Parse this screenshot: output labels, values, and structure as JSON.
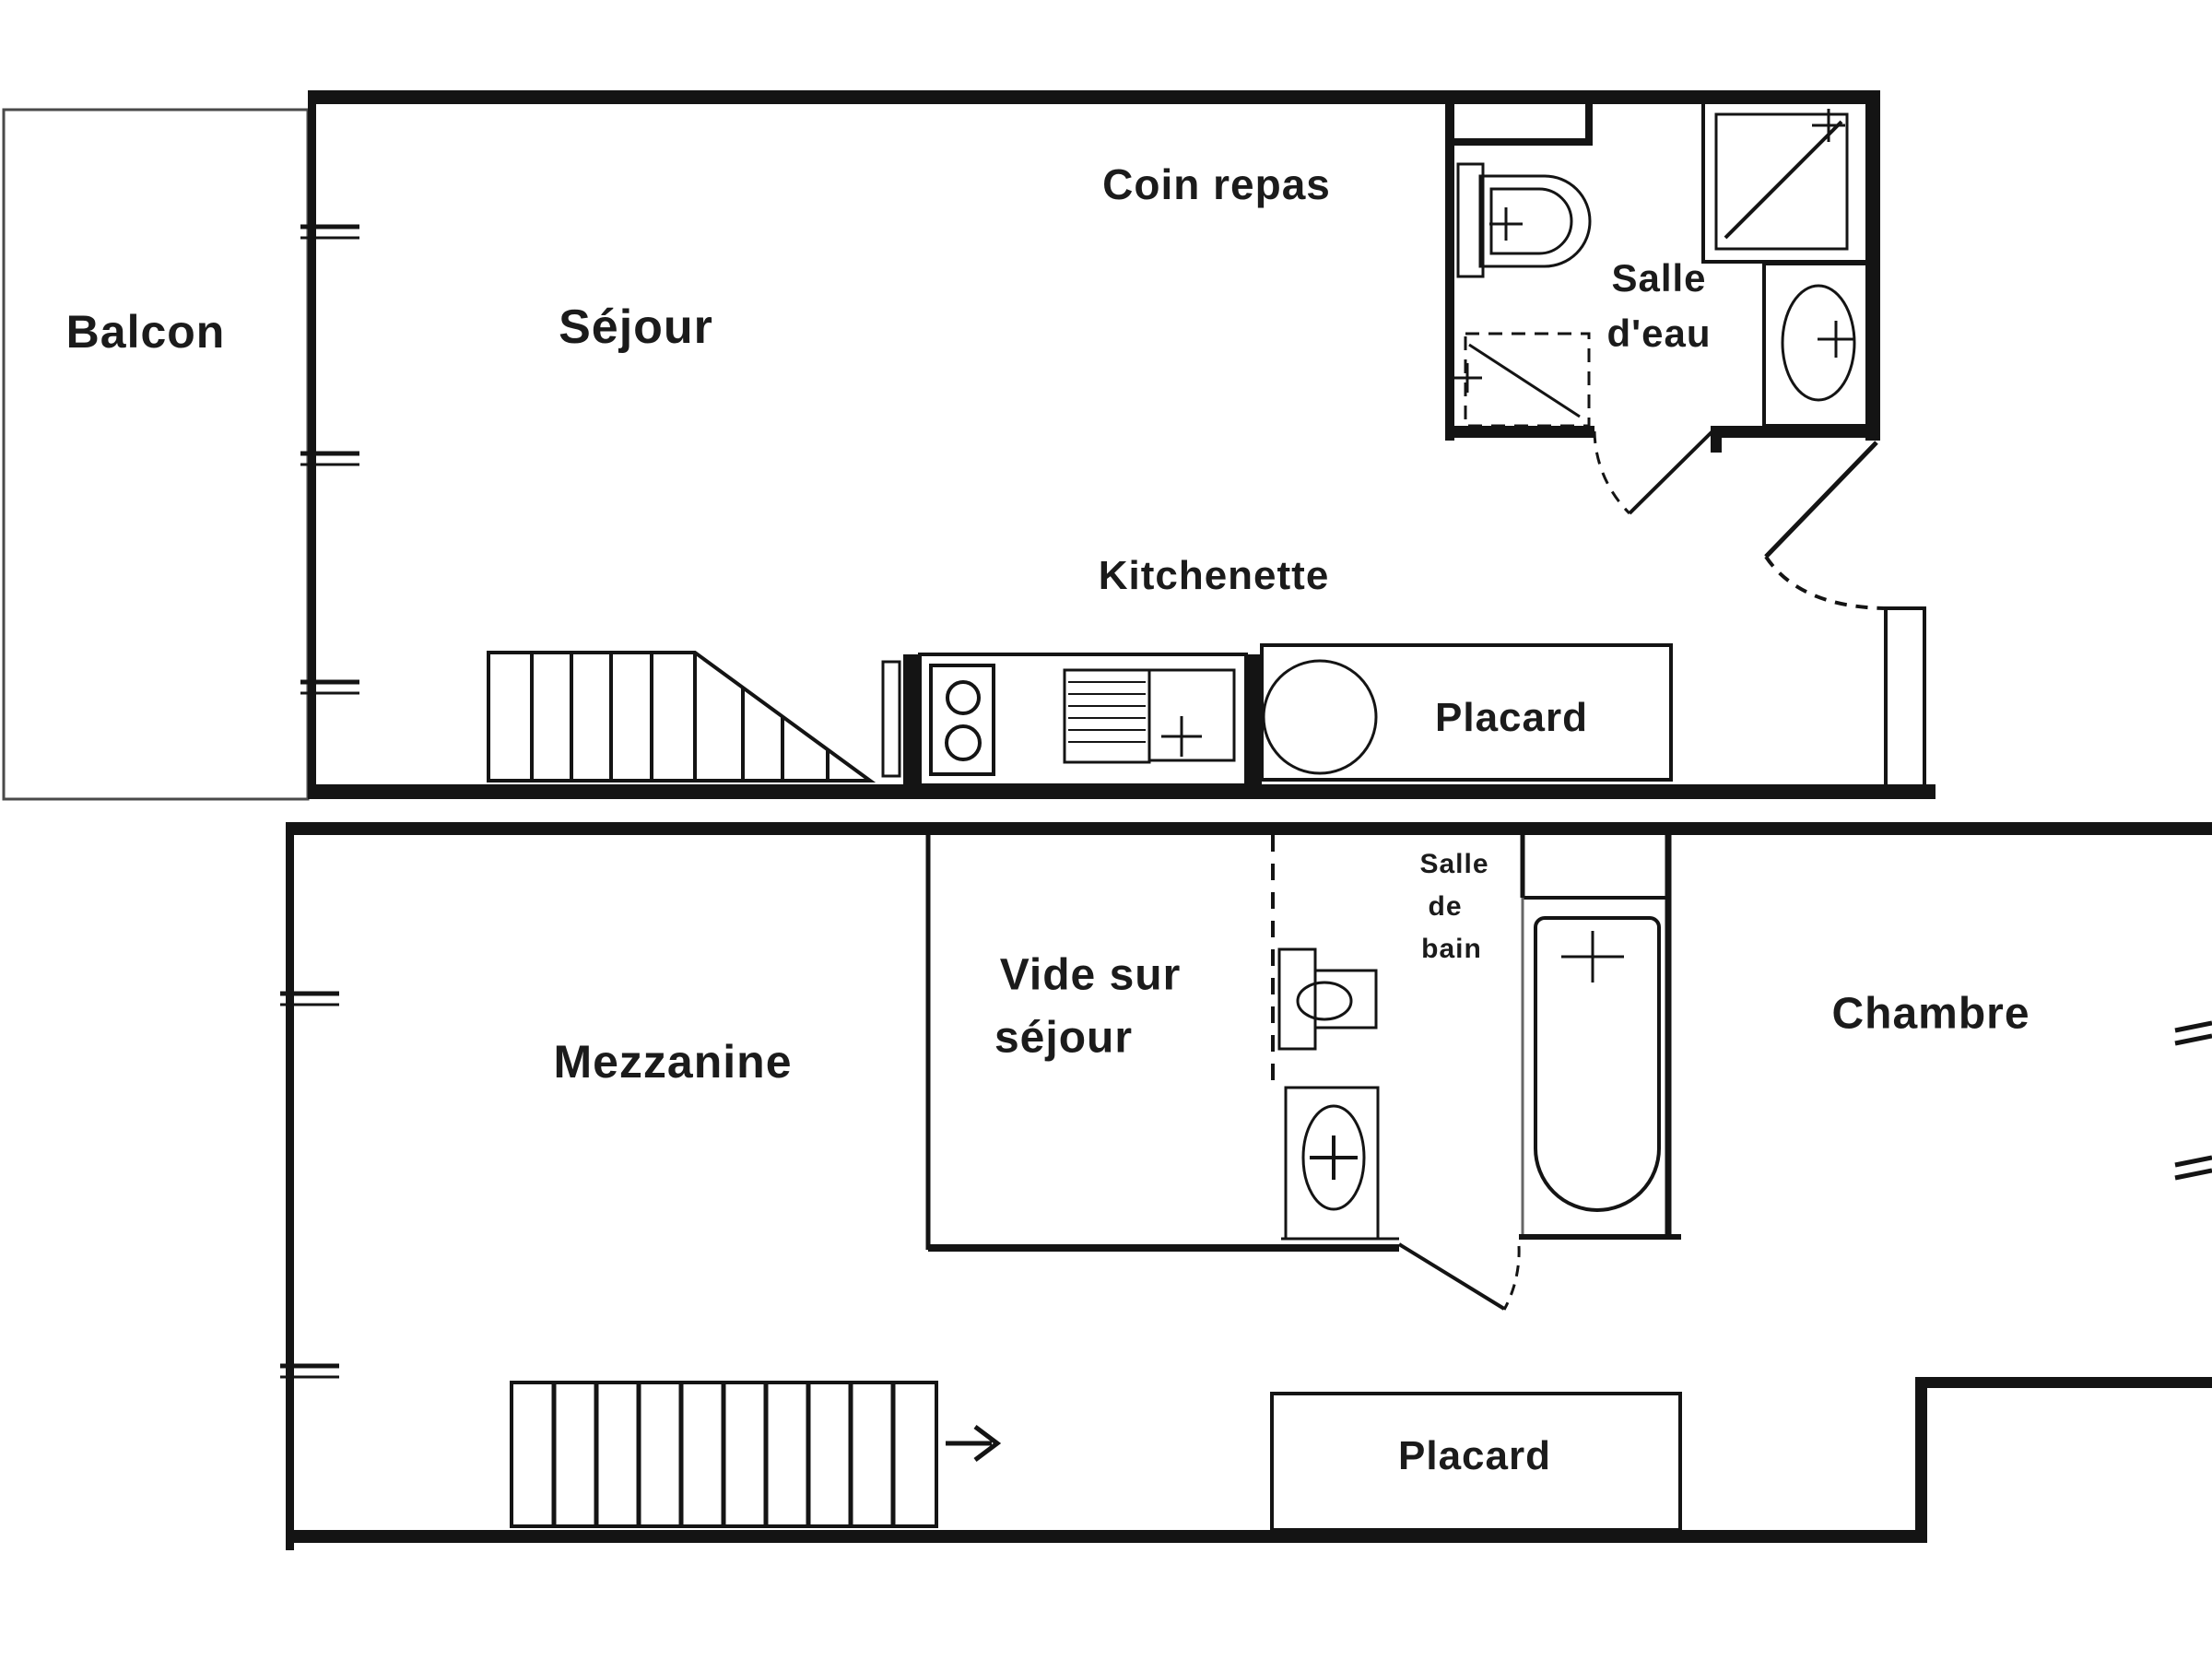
{
  "page": {
    "type": "floor-plan",
    "background": "#ffffff",
    "line_color": "#141414",
    "balcony_line_color": "#4a4a4a",
    "text_color": "#1b1b1b"
  },
  "floors": {
    "upper": {
      "rooms": {
        "balcon": "Balcon",
        "sejour": "Séjour",
        "coin_repas": "Coin repas",
        "kitchenette": "Kitchenette",
        "salle_eau_line1": "Salle",
        "salle_eau_line2": "d'eau",
        "placard": "Placard"
      },
      "fixtures": [
        "cupboard",
        "toilet",
        "shower",
        "washbasin",
        "washing-machine",
        "stove",
        "sink",
        "water-heater",
        "stairs",
        "door-swing",
        "entry-door-swing",
        "windows"
      ]
    },
    "lower": {
      "rooms": {
        "mezzanine": "Mezzanine",
        "vide_line1": "Vide sur",
        "vide_line2": "séjour",
        "salle_de_bain_line1": "Salle",
        "salle_de_bain_line2": "de",
        "salle_de_bain_line3": "bain",
        "chambre": "Chambre",
        "placard": "Placard"
      },
      "fixtures": [
        "toilet",
        "washbasin",
        "bathtub",
        "stairs",
        "direction-arrow",
        "door-swing",
        "windows"
      ]
    }
  }
}
